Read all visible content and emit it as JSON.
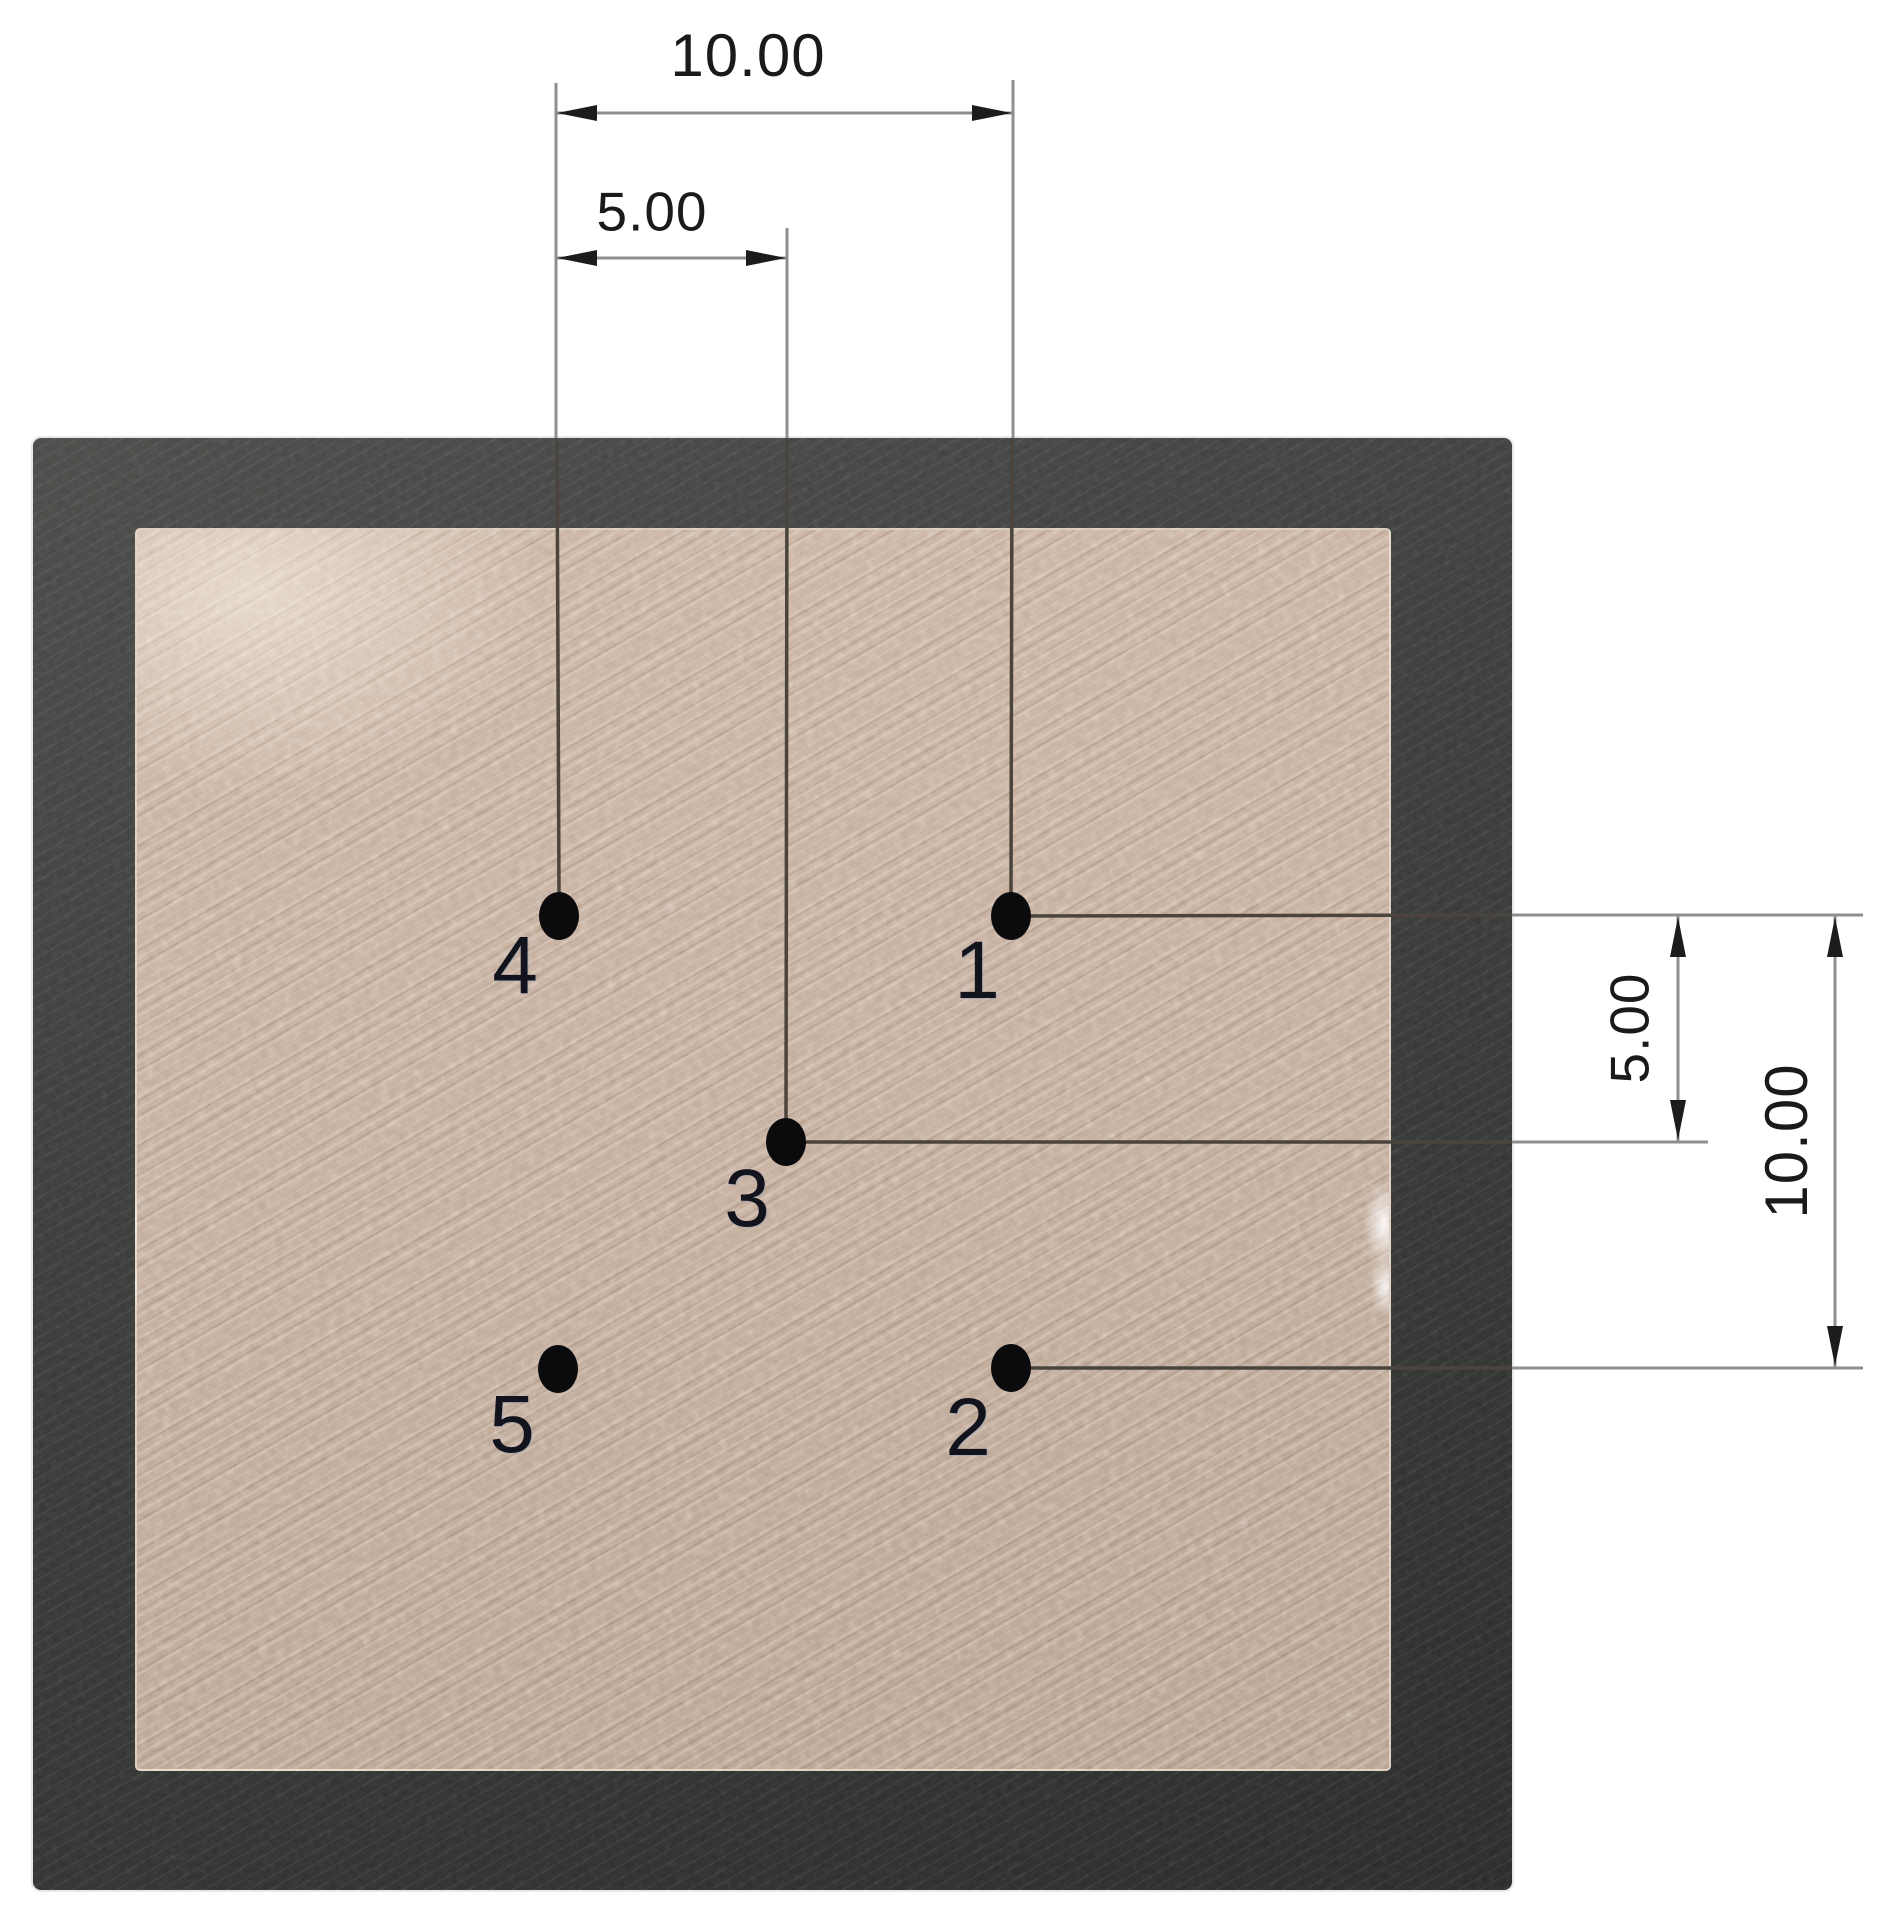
{
  "figure": {
    "points": [
      {
        "id": "1"
      },
      {
        "id": "2"
      },
      {
        "id": "3"
      },
      {
        "id": "4"
      },
      {
        "id": "5"
      }
    ],
    "dimensions": {
      "top_outer": {
        "label": "10.00",
        "orientation": "horizontal"
      },
      "top_inner": {
        "label": "5.00",
        "orientation": "horizontal"
      },
      "right_inner": {
        "label": "5.00",
        "orientation": "vertical"
      },
      "right_outer": {
        "label": "10.00",
        "orientation": "vertical"
      }
    },
    "colors": {
      "background": "#ffffff",
      "photo_dark": "#383a38",
      "sample_tan": "#c2ab9a",
      "dimension_line": "#8f8f8f",
      "leader_dark": "#4a443d",
      "arrowhead": "#1c1c1c",
      "point_dot": "#0b0b0e",
      "point_label_text": "#13131d",
      "dimension_text": "#1a1a1a"
    }
  }
}
